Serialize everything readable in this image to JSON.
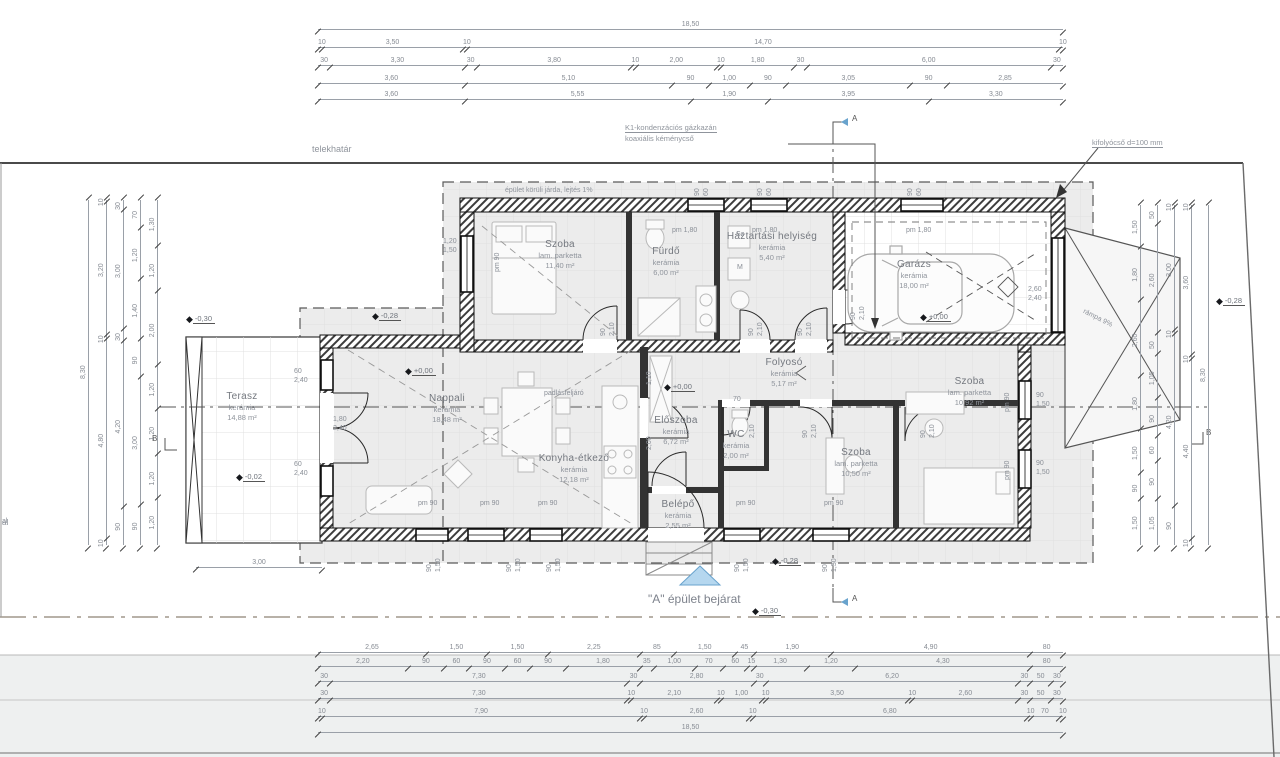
{
  "drawing": {
    "annotations": {
      "telekhatar": "telekhatár",
      "jarda": "épület körüli járda, lejtés 1%",
      "kazan_line1": "K1-kondenzációs gázkazán",
      "kazan_line2": "koaxiális kéménycső",
      "kifolyocso": "kifolyócső d=100 mm",
      "bejarat": "\"A\" épület bejárat",
      "rampa": "rámpa 9%",
      "padlasfeljaro": "padlásfeljáró",
      "edge_fragment": "al"
    },
    "section_markers": {
      "a": "A",
      "b": "B"
    },
    "accent_colors": {
      "entrance_triangle": "#b5d7ef",
      "entrance_border": "#69a3cd",
      "road_axis": "#8d8273"
    },
    "rooms": [
      {
        "name": "Szoba",
        "finish": "lam. parketta",
        "area": "11,40 m²"
      },
      {
        "name": "Fürdő",
        "finish": "kerámia",
        "area": "6,00 m²"
      },
      {
        "name": "Háztartási helyiség",
        "finish": "kerámia",
        "area": "5,40 m²"
      },
      {
        "name": "Garázs",
        "finish": "kerámia",
        "area": "18,00 m²"
      },
      {
        "name": "Terasz",
        "finish": "kerámia",
        "area": "14,88 m²"
      },
      {
        "name": "Nappali",
        "finish": "kerámia",
        "area": "18,48 m²"
      },
      {
        "name": "Konyha-étkező",
        "finish": "kerámia",
        "area": "12,18 m²"
      },
      {
        "name": "Előszoba",
        "finish": "kerámia",
        "area": "6,72 m²"
      },
      {
        "name": "WC",
        "finish": "kerámia",
        "area": "2,00 m²"
      },
      {
        "name": "Folyosó",
        "finish": "kerámia",
        "area": "5,17 m²"
      },
      {
        "name": "Szoba",
        "finish": "lam. parketta",
        "area": "10,50 m²"
      },
      {
        "name": "Szoba",
        "finish": "lam. parketta",
        "area": "10,92 m²"
      },
      {
        "name": "Belépő",
        "finish": "kerámia",
        "area": "2,55 m²"
      }
    ],
    "levels": [
      {
        "t": "+0,00",
        "x": 405,
        "y": 370
      },
      {
        "t": "+0,00",
        "x": 664,
        "y": 386
      },
      {
        "t": "+0,00",
        "x": 920,
        "y": 316
      },
      {
        "t": "-0,02",
        "x": 236,
        "y": 476
      },
      {
        "t": "-0,30",
        "x": 186,
        "y": 318
      },
      {
        "t": "-0,28",
        "x": 372,
        "y": 315
      },
      {
        "t": "-0,28",
        "x": 1216,
        "y": 300
      },
      {
        "t": "-0,28",
        "x": 772,
        "y": 560
      },
      {
        "t": "-0,30",
        "x": 752,
        "y": 610
      }
    ],
    "labels": [
      {
        "t": "pm 1,80",
        "x": 672,
        "y": 227
      },
      {
        "t": "pm 1,80",
        "x": 752,
        "y": 227
      },
      {
        "t": "pm 1,80",
        "x": 906,
        "y": 227
      },
      {
        "t": "90",
        "x": 694,
        "y": 196,
        "r": -90
      },
      {
        "t": "60",
        "x": 703,
        "y": 196,
        "r": -90
      },
      {
        "t": "90",
        "x": 757,
        "y": 196,
        "r": -90
      },
      {
        "t": "60",
        "x": 766,
        "y": 196,
        "r": -90
      },
      {
        "t": "90",
        "x": 907,
        "y": 196,
        "r": -90
      },
      {
        "t": "60",
        "x": 916,
        "y": 196,
        "r": -90
      },
      {
        "t": "1,20",
        "x": 443,
        "y": 238
      },
      {
        "t": "1,50",
        "x": 443,
        "y": 247
      },
      {
        "t": "pm 90",
        "x": 494,
        "y": 272,
        "r": -90
      },
      {
        "t": "pm 90",
        "x": 418,
        "y": 500
      },
      {
        "t": "pm 90",
        "x": 480,
        "y": 500
      },
      {
        "t": "pm 90",
        "x": 538,
        "y": 500
      },
      {
        "t": "pm 90",
        "x": 736,
        "y": 500
      },
      {
        "t": "pm 90",
        "x": 824,
        "y": 500
      },
      {
        "t": "90",
        "x": 426,
        "y": 572,
        "r": -90
      },
      {
        "t": "1,50",
        "x": 435,
        "y": 572,
        "r": -90
      },
      {
        "t": "90",
        "x": 506,
        "y": 572,
        "r": -90
      },
      {
        "t": "1,50",
        "x": 515,
        "y": 572,
        "r": -90
      },
      {
        "t": "90",
        "x": 546,
        "y": 572,
        "r": -90
      },
      {
        "t": "1,50",
        "x": 555,
        "y": 572,
        "r": -90
      },
      {
        "t": "90",
        "x": 734,
        "y": 572,
        "r": -90
      },
      {
        "t": "1,50",
        "x": 743,
        "y": 572,
        "r": -90
      },
      {
        "t": "90",
        "x": 822,
        "y": 572,
        "r": -90
      },
      {
        "t": "1,50",
        "x": 831,
        "y": 572,
        "r": -90
      },
      {
        "t": "90",
        "x": 1036,
        "y": 392
      },
      {
        "t": "1,50",
        "x": 1036,
        "y": 401
      },
      {
        "t": "pm 90",
        "x": 1004,
        "y": 412,
        "r": -90
      },
      {
        "t": "90",
        "x": 1036,
        "y": 460
      },
      {
        "t": "1,50",
        "x": 1036,
        "y": 469
      },
      {
        "t": "pm 90",
        "x": 1004,
        "y": 480,
        "r": -90
      },
      {
        "t": "60",
        "x": 294,
        "y": 368
      },
      {
        "t": "2,40",
        "x": 294,
        "y": 377
      },
      {
        "t": "60",
        "x": 294,
        "y": 461
      },
      {
        "t": "2,40",
        "x": 294,
        "y": 470
      },
      {
        "t": "1,80",
        "x": 333,
        "y": 416
      },
      {
        "t": "2,40",
        "x": 333,
        "y": 425
      },
      {
        "t": "2,60",
        "x": 1028,
        "y": 286
      },
      {
        "t": "2,40",
        "x": 1028,
        "y": 295
      },
      {
        "t": "90",
        "x": 600,
        "y": 336,
        "r": -90
      },
      {
        "t": "2,10",
        "x": 609,
        "y": 336,
        "r": -90
      },
      {
        "t": "90",
        "x": 748,
        "y": 336,
        "r": -90
      },
      {
        "t": "2,10",
        "x": 757,
        "y": 336,
        "r": -90
      },
      {
        "t": "90",
        "x": 797,
        "y": 336,
        "r": -90
      },
      {
        "t": "2,10",
        "x": 806,
        "y": 336,
        "r": -90
      },
      {
        "t": "90",
        "x": 850,
        "y": 320,
        "r": -90
      },
      {
        "t": "2,10",
        "x": 859,
        "y": 320,
        "r": -90
      },
      {
        "t": "90",
        "x": 802,
        "y": 438,
        "r": -90
      },
      {
        "t": "2,10",
        "x": 811,
        "y": 438,
        "r": -90
      },
      {
        "t": "90",
        "x": 920,
        "y": 438,
        "r": -90
      },
      {
        "t": "2,10",
        "x": 929,
        "y": 438,
        "r": -90
      },
      {
        "t": "70",
        "x": 733,
        "y": 396
      },
      {
        "t": "2,10",
        "x": 749,
        "y": 438,
        "r": -90
      },
      {
        "t": "1,10",
        "x": 646,
        "y": 385,
        "r": -90
      },
      {
        "t": "2,00",
        "x": 646,
        "y": 450,
        "r": -90
      },
      {
        "t": "Sz",
        "x": 736,
        "y": 231
      },
      {
        "t": "M",
        "x": 737,
        "y": 264
      },
      {
        "t": "rámpa 9%",
        "x": 1085,
        "y": 308,
        "r": 27
      },
      {
        "t": "padlásfeljáró",
        "x": 544,
        "y": 390
      },
      {
        "t": "al",
        "x": 2,
        "y": 518
      }
    ],
    "dims": {
      "top": {
        "x": 318,
        "w": 745,
        "ys": [
          30,
          48,
          66,
          84,
          100
        ],
        "rows": [
          [
            "18,50"
          ],
          [
            "10",
            "3,50",
            "10",
            "14,70",
            "10"
          ],
          [
            "30",
            "3,30",
            "30",
            "3,80",
            "10",
            "2,00",
            "10",
            "1,80",
            "30",
            "6,00",
            "30"
          ],
          [
            "3,60",
            "5,10",
            "90",
            "1,00",
            "90",
            "3,05",
            "90",
            "2,85"
          ],
          [
            "3,60",
            "5,55",
            "1,90",
            "3,95",
            "3,30"
          ]
        ]
      },
      "bottom": {
        "x": 318,
        "w": 745,
        "ys": [
          653,
          667,
          682,
          699,
          717,
          733
        ],
        "rows": [
          [
            "2,65",
            "1,50",
            "1,50",
            "2,25",
            "85",
            "1,50",
            "45",
            "1,90",
            "4,90",
            "80"
          ],
          [
            "2,20",
            "90",
            "60",
            "90",
            "60",
            "90",
            "1,80",
            "35",
            "1,00",
            "70",
            "60",
            "15",
            "1,30",
            "1,20",
            "4,30",
            "80"
          ],
          [
            "30",
            "7,30",
            "30",
            "2,80",
            "30",
            "6,20",
            "30",
            "50",
            "30"
          ],
          [
            "30",
            "7,30",
            "10",
            "2,10",
            "10",
            "1,00",
            "10",
            "3,50",
            "10",
            "2,60",
            "30",
            "50",
            "30"
          ],
          [
            "10",
            "7,90",
            "10",
            "2,60",
            "10",
            "6,80",
            "10",
            "70",
            "10"
          ],
          [
            "18,50"
          ]
        ]
      },
      "left": {
        "y": 200,
        "h": 345,
        "xs": [
          88,
          106,
          123,
          140,
          157
        ],
        "cols": [
          [
            "8,30"
          ],
          [
            "10",
            "3,20",
            "10",
            "4,80",
            "10"
          ],
          [
            "30",
            "3,00",
            "30",
            "4,20",
            "90"
          ],
          [
            "70",
            "1,20",
            "1,40",
            "90",
            "3,00",
            "90"
          ],
          [
            "1,30",
            "1,20",
            "2,00",
            "1,20",
            "1,20",
            "1,20",
            "1,20"
          ]
        ]
      },
      "right": {
        "y": 205,
        "h": 340,
        "xs": [
          1140,
          1157,
          1174,
          1191,
          1208
        ],
        "cols": [
          [
            "1,50",
            "1,80",
            "2,60",
            "1,80",
            "1,50",
            "90",
            "1,50"
          ],
          [
            "50",
            "2,60",
            "50",
            "1,05",
            "90",
            "60",
            "90",
            "1,05"
          ],
          [
            "10",
            "3,00",
            "10",
            "4,20",
            "90"
          ],
          [
            "10",
            "3,60",
            "10",
            "4,40",
            "10"
          ],
          [
            "8,30"
          ]
        ]
      },
      "extra": [
        {
          "x": 196,
          "y": 568,
          "w": 126,
          "rows": [
            [
              "3,00"
            ]
          ]
        }
      ]
    }
  }
}
